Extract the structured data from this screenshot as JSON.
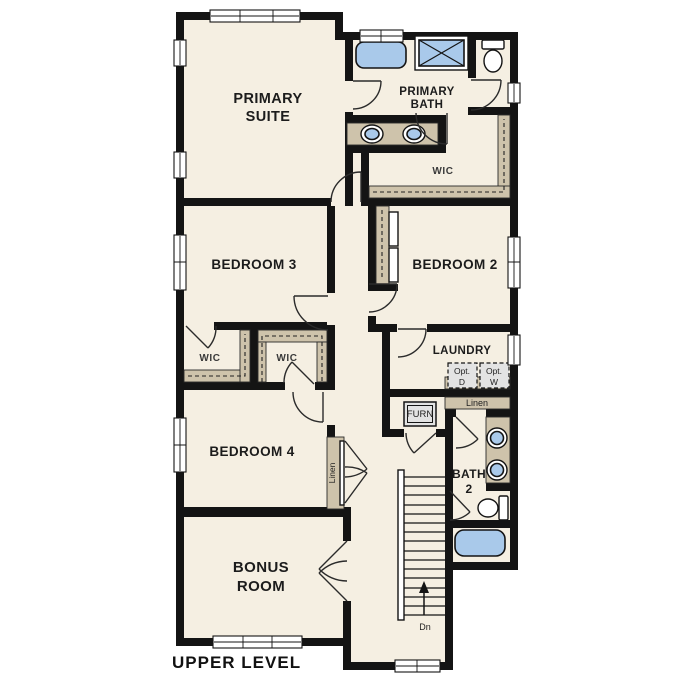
{
  "plan": {
    "title": "UPPER LEVEL",
    "colors": {
      "floor": "#f5efe2",
      "wall": "#141414",
      "shelf": "#cec3ab",
      "fixture": "#a9c9ea",
      "appliance": "#e3e3e3"
    },
    "rooms": {
      "primary_suite": {
        "line1": "PRIMARY",
        "line2": "SUITE"
      },
      "primary_bath": {
        "line1": "PRIMARY",
        "line2": "BATH"
      },
      "primary_wic": {
        "label": "WIC"
      },
      "bedroom3": {
        "label": "BEDROOM 3"
      },
      "bedroom2": {
        "label": "BEDROOM 2"
      },
      "laundry": {
        "label": "LAUNDRY"
      },
      "wic_bedroom3": {
        "label": "WIC"
      },
      "wic_bedroom4": {
        "label": "WIC"
      },
      "bedroom4": {
        "label": "BEDROOM 4"
      },
      "bath2": {
        "line1": "BATH",
        "line2": "2"
      },
      "bonus_room": {
        "line1": "BONUS",
        "line2": "ROOM"
      }
    },
    "features": {
      "opt_dryer": {
        "line1": "Opt.",
        "line2": "D"
      },
      "opt_washer": {
        "line1": "Opt.",
        "line2": "W"
      },
      "linen_hall": {
        "label": "Linen"
      },
      "linen_bedroom4": {
        "label": "Linen"
      },
      "furnace": {
        "label": "FURN"
      },
      "stair_direction": {
        "label": "Dn"
      }
    }
  }
}
